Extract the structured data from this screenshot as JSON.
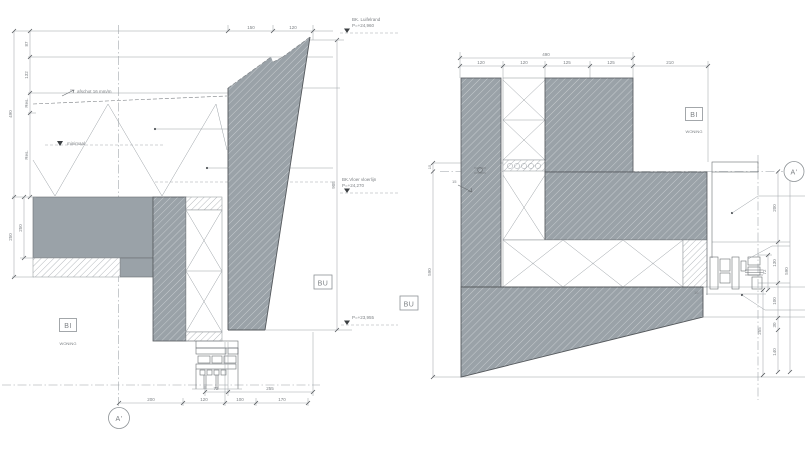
{
  "left": {
    "dims": {
      "top": [
        "150",
        "120"
      ],
      "outer_height": "490",
      "inner_heights": [
        "87",
        "132",
        "Res.",
        "Res."
      ],
      "lower_heights": [
        "250",
        "250"
      ],
      "right_height": "905",
      "bottom_upper": [
        "72",
        "255"
      ],
      "bottom_lower": [
        "200",
        "120",
        "100",
        "170"
      ]
    },
    "labels": {
      "slope": "afschot 16 mm/m",
      "minimal": "minimaal",
      "level_top_name": "BK. Luifelrand",
      "level_top_value": "P=+24,960",
      "level_floor_name": "BK.Vloer vloerlijn",
      "level_floor_value": "P=+24,270",
      "level_low_value": "P=+23,955",
      "zone_in_code": "BI",
      "zone_in_label": "WONING",
      "zone_out_code": "BU",
      "grid_bubble": "A'"
    }
  },
  "right": {
    "dims": {
      "top_overall": "490",
      "top_segments": [
        "120",
        "120",
        "125",
        "125",
        "210"
      ],
      "left_top": "15",
      "left_height": "590",
      "right_outer": "590",
      "right_segments": [
        "200",
        "130",
        "100",
        "30",
        "140"
      ],
      "right_small": [
        "72",
        "255"
      ],
      "slope": "15",
      "edge": "16"
    },
    "labels": {
      "zone_in_code": "BI",
      "zone_in_label": "WONING",
      "zone_out_code": "BU",
      "grid_bubble": "A'"
    }
  },
  "colors": {
    "concrete_fill": "#9aa2a8",
    "hatch_line_on_gray": "#c6cbcf",
    "hatch_line_light": "#979da2",
    "outline": "#55595d",
    "dimension": "#a2a7ab",
    "text": "#7d8185"
  }
}
